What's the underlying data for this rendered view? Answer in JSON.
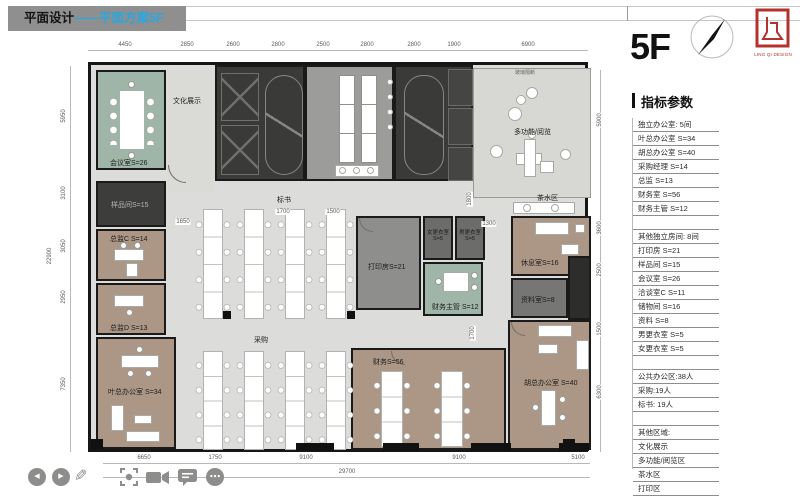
{
  "title": {
    "prefix": "平面设计",
    "highlight": "——平面方案5F"
  },
  "floor_label": "5F",
  "logo": {
    "text": "LING QI DESIGN"
  },
  "panel": {
    "heading": "指标参数",
    "rows": [
      "独立办公室: 5间",
      "叶总办公室 S=34",
      "胡总办公室 S=40",
      "采购经理 S=14",
      "总监 S=13",
      "财务室 S=56",
      "财务主管 S=12",
      "",
      "其他独立房间: 8间",
      "打印房 S=21",
      "样品间 S=15",
      "会议室 S=26",
      "洽谈室C S=11",
      "储物间 S=16",
      "资料 S=8",
      "男更衣室 S=5",
      "女更衣室 S=5",
      "",
      "公共办公区:38人",
      "采购:19人",
      "标书: 19人",
      "",
      "其他区域:",
      "文化展示",
      "多功能/阅览区",
      "茶水区",
      "打印区"
    ]
  },
  "plan": {
    "rooms": {
      "meeting": "会议室S=26",
      "culture": "文化展示",
      "multi": "多功能/阅览",
      "tea": "茶水区",
      "rest": "休息室S=16",
      "archive": "资料室S=8",
      "hu": "胡总办公室 S=40",
      "finance": "财务S=56",
      "print": "打印房S=21",
      "women": "女更衣室 S=5",
      "men": "男更衣室 S=5",
      "finsup": "财务主管 S=12",
      "sample": "样品间S=15",
      "dirc": "总监C S=14",
      "dird": "总监D S=13",
      "ye": "叶总办公室 S=34",
      "bid": "标书",
      "purchase": "采购",
      "partition_note": "玻璃隔断"
    },
    "dims": {
      "top": [
        "4450",
        "2850",
        "2600",
        "2800",
        "2500",
        "2800",
        "2800",
        "1900",
        "6900"
      ],
      "bottom": [
        "6650",
        "1750",
        "9100",
        "9100",
        "5100"
      ],
      "bottom_total": "29700",
      "left": [
        "5950",
        "3100",
        "3050",
        "2950",
        "7350"
      ],
      "left_total": "22900",
      "right": [
        "5900",
        "3600",
        "2500",
        "1500",
        "6300"
      ],
      "inner": {
        "a": "1650",
        "b": "1700",
        "c": "1500",
        "d": "1300",
        "e": "1800",
        "f": "1700"
      }
    }
  },
  "toolbar": {
    "prev_glyph": "◀",
    "play_glyph": "▶",
    "pencil_glyph": "✎",
    "more_glyph": "⋯"
  }
}
